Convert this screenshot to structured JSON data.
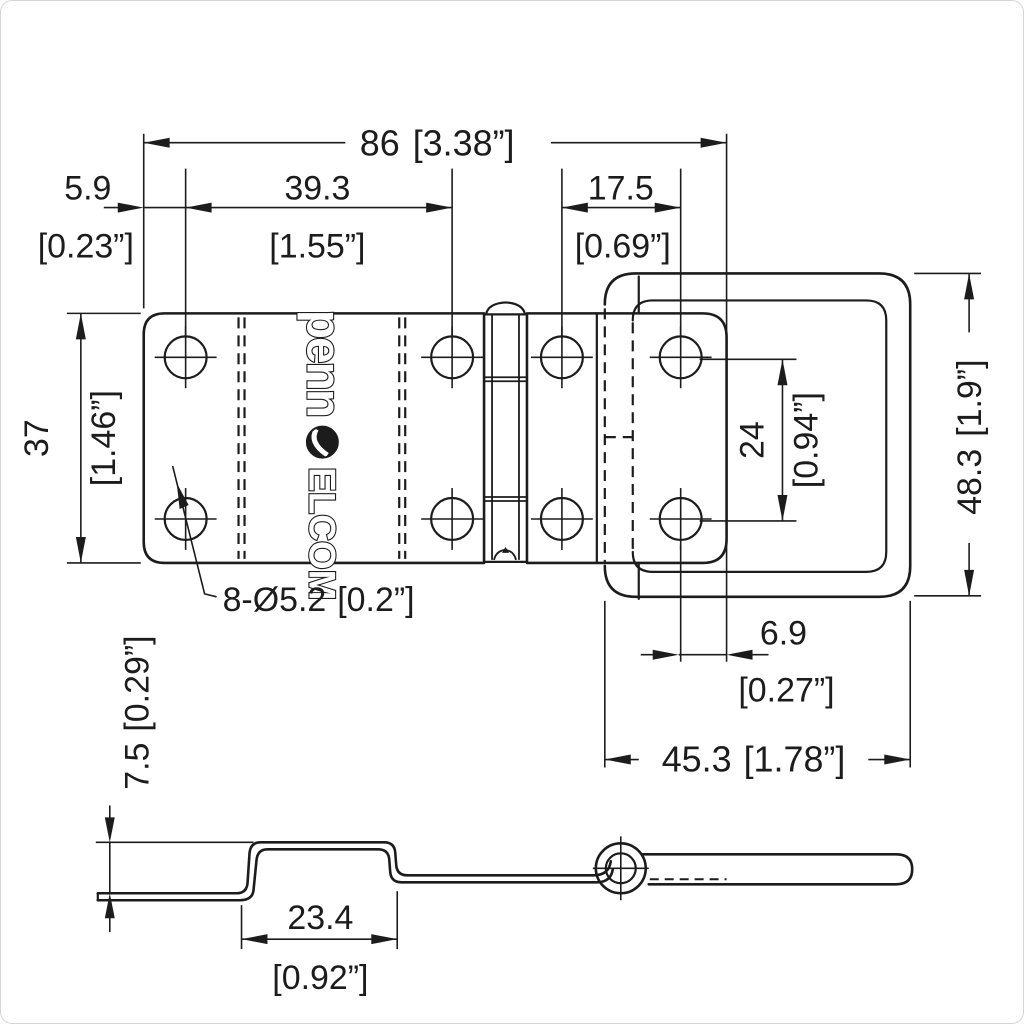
{
  "title": "Penn Elcom concealed hinge technical drawing",
  "brand": {
    "word_lower": "penn",
    "word_upper": "ELCOM"
  },
  "colors": {
    "line": "#1c1c1c",
    "background": "#ffffff"
  },
  "dims": {
    "overall_length": {
      "mm": "86",
      "inch": "[3.38”]"
    },
    "hole_edge_offset": {
      "mm": "5.9",
      "inch": "[0.23”]"
    },
    "left_hole_spacing": {
      "mm": "39.3",
      "inch": "[1.55”]"
    },
    "right_hole_spacing": {
      "mm": "17.5",
      "inch": "[0.69”]"
    },
    "leaf_width": {
      "mm": "37",
      "inch": "[1.46”]"
    },
    "flap_width": {
      "mm": "48.3",
      "inch": "[1.9”]"
    },
    "hole_row_spacing": {
      "mm": "24",
      "inch": "[0.94”]"
    },
    "hole_callout": {
      "mm": "8-Ø5.2",
      "inch": "[0.2”]"
    },
    "hole_flap_edge_offset": {
      "mm": "6.9",
      "inch": "[0.27”]"
    },
    "flap_length": {
      "mm": "45.3",
      "inch": "[1.78”]"
    },
    "offset_depth": {
      "mm": "7.5",
      "inch": "[0.29”]"
    },
    "channel_width": {
      "mm": "23.4",
      "inch": "[0.92”]"
    }
  }
}
